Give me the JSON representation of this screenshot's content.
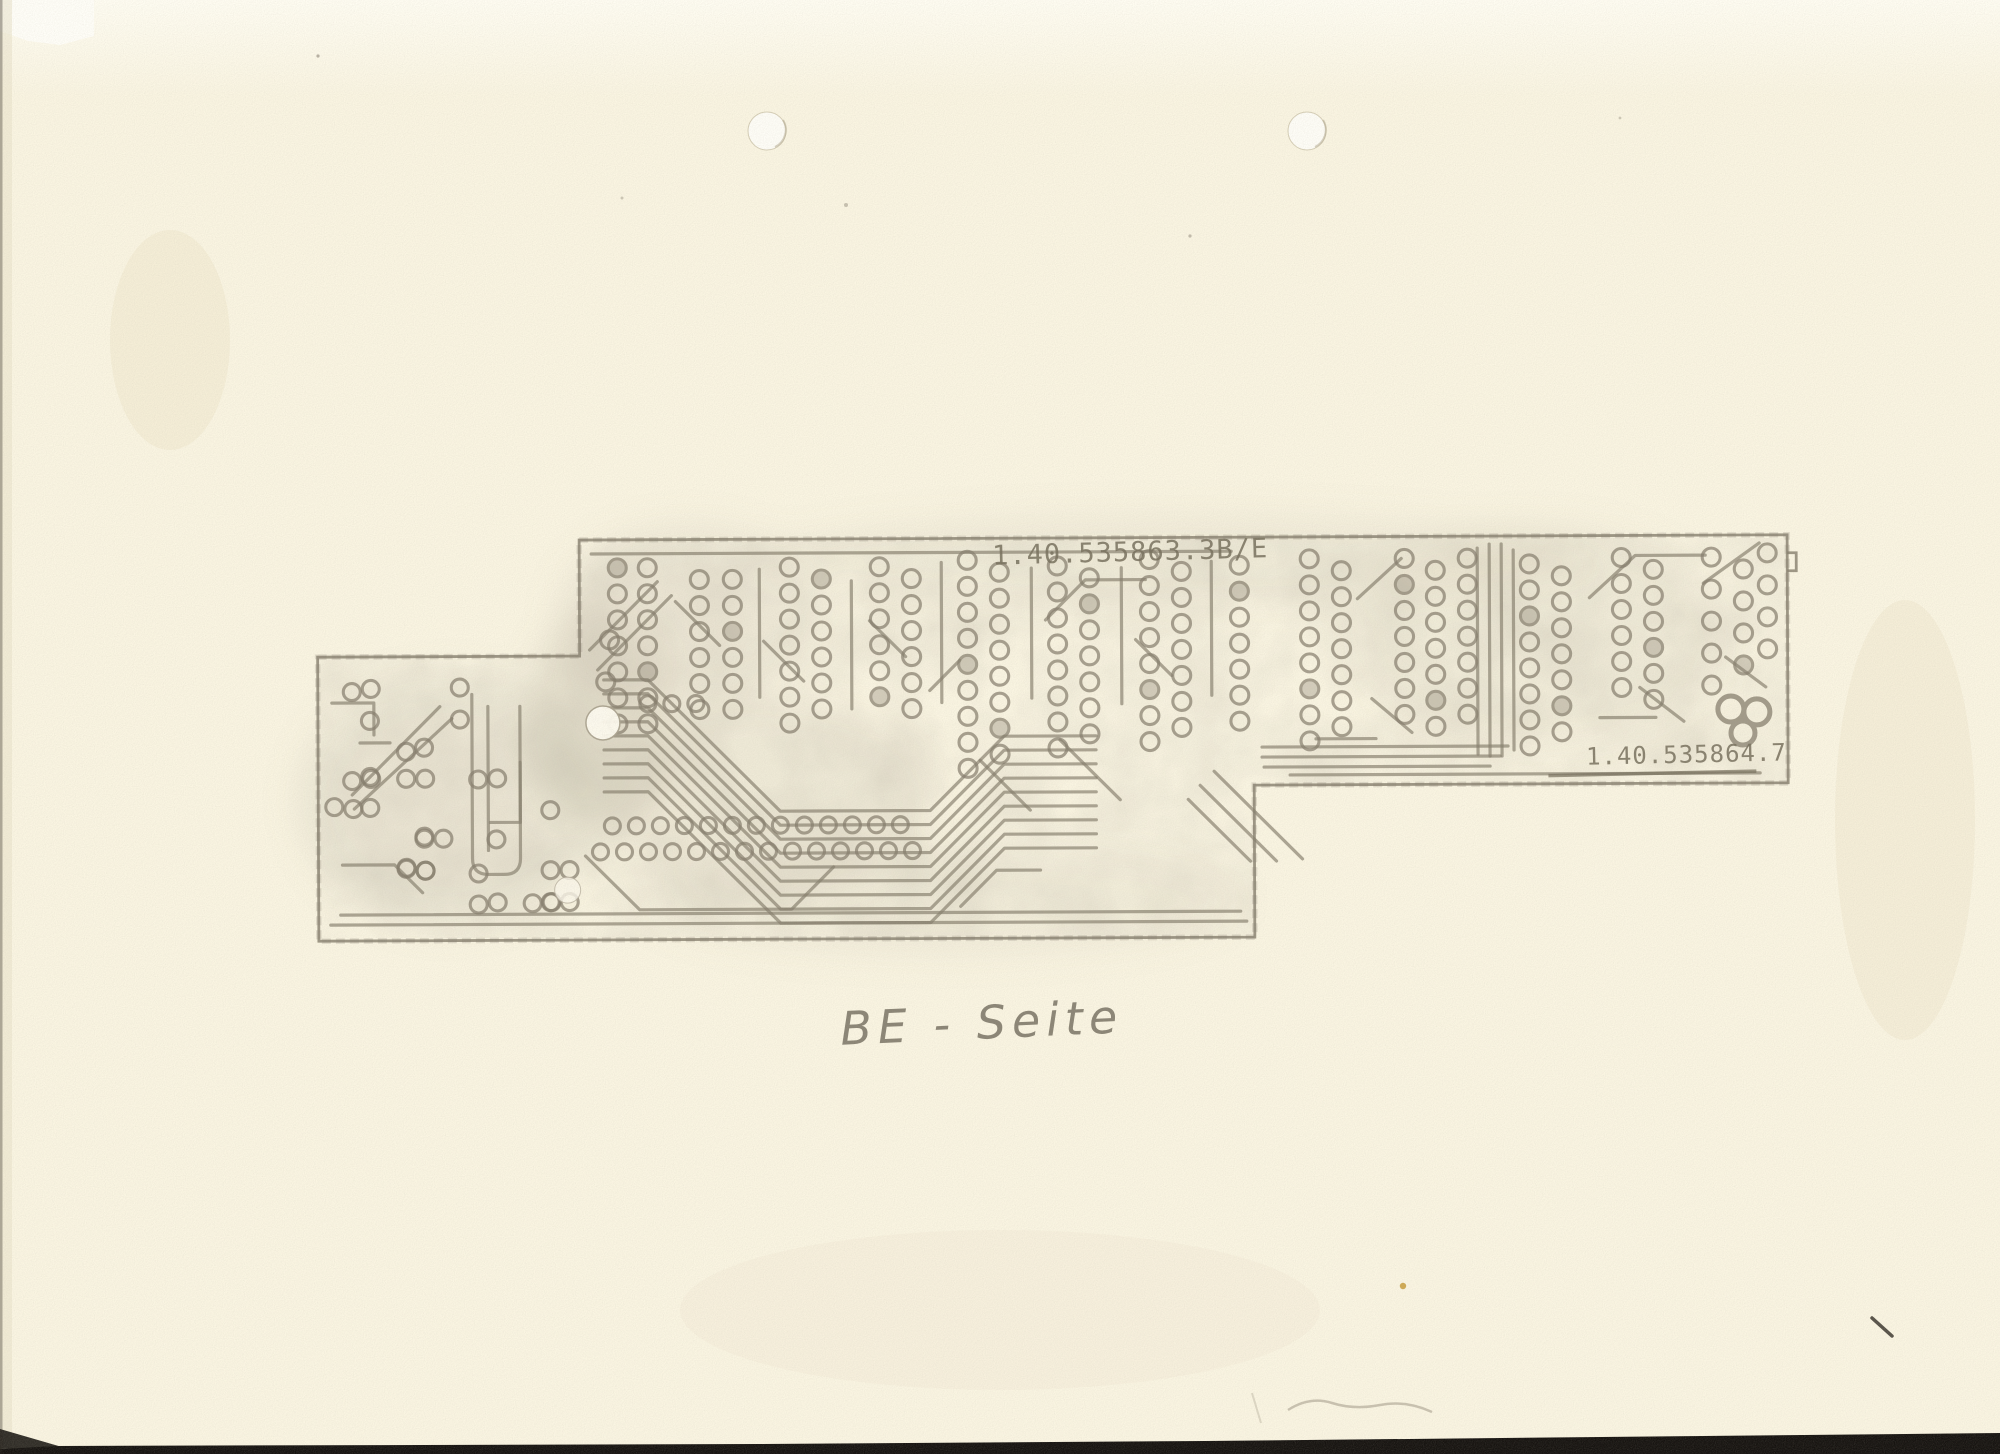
{
  "document": {
    "labels": {
      "board_number_main": "1.40.535863.3B/E",
      "board_number_right": "1.40.535864.7",
      "caption_handwritten": "BE - Seite"
    },
    "colors": {
      "paper": "#faf5e2",
      "paper_light": "#fffdf3",
      "trace_gray": "#857d6c",
      "stamp_gray": "#756e5b",
      "pencil_gray": "#6e6859",
      "scanner_edge_black": "#161310",
      "stain_yellow": "#c79b3a"
    },
    "artifacts": {
      "punch_hole_count": 2,
      "content_type": "pcb-solder-side-photocopy"
    }
  }
}
